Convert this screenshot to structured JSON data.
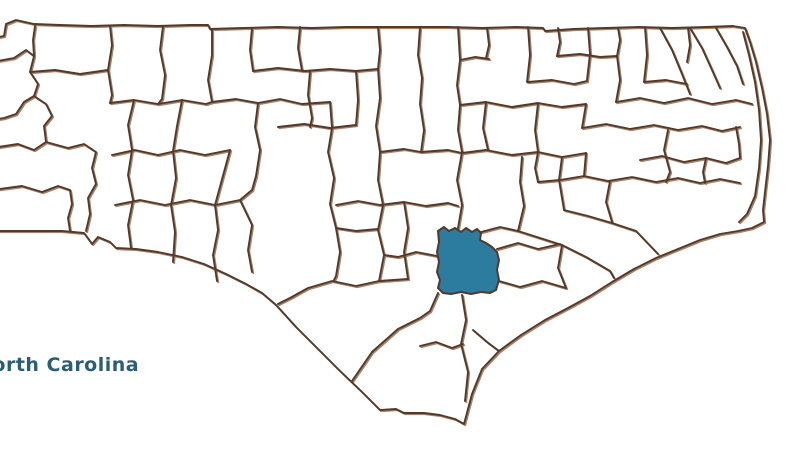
{
  "page": {
    "background": "#ffffff",
    "title": "North Carolina county map"
  },
  "map": {
    "label": "North Carolina",
    "label_color": "#2b5e74",
    "line_color": "#54392a",
    "line_color_light": "#a3836a",
    "highlight_fill": "#2b7c9e"
  }
}
